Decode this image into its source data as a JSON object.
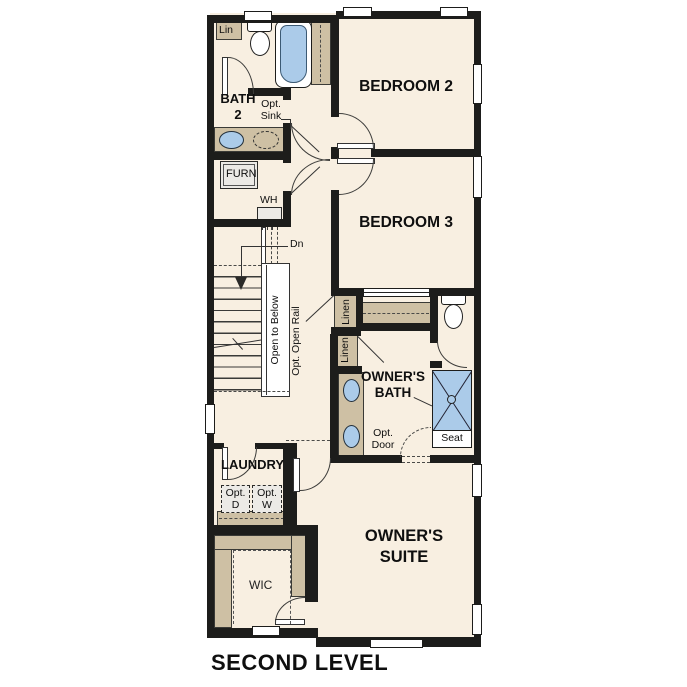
{
  "title": "SECOND LEVEL",
  "colors": {
    "floor": "#f8efe1",
    "wall": "#1d1d1b",
    "casework_tan": "#cec0a4",
    "fixture_blue": "#abcbe9",
    "appliance_gray": "#eceae6"
  },
  "rooms": {
    "bedroom2": "BEDROOM 2",
    "bedroom3": "BEDROOM 3",
    "owners_suite": [
      "OWNER'S",
      "SUITE"
    ],
    "owners_bath": [
      "OWNER'S",
      "BATH"
    ],
    "bath2": [
      "BATH",
      "2"
    ],
    "laundry": "LAUNDRY",
    "wic": "WIC"
  },
  "annotations": {
    "lin": "Lin",
    "linen_upper": "Linen",
    "linen_lower": "Linen",
    "furnace": "FURN",
    "water_heater": "WH",
    "down": "Dn",
    "open_to_below": "Open to Below",
    "opt_open_rail": "Opt. Open Rail",
    "opt_sink": [
      "Opt.",
      "Sink"
    ],
    "opt_dryer": [
      "Opt.",
      "D"
    ],
    "opt_washer": [
      "Opt.",
      "W"
    ],
    "opt_door": [
      "Opt.",
      "Door"
    ],
    "seat": "Seat"
  }
}
